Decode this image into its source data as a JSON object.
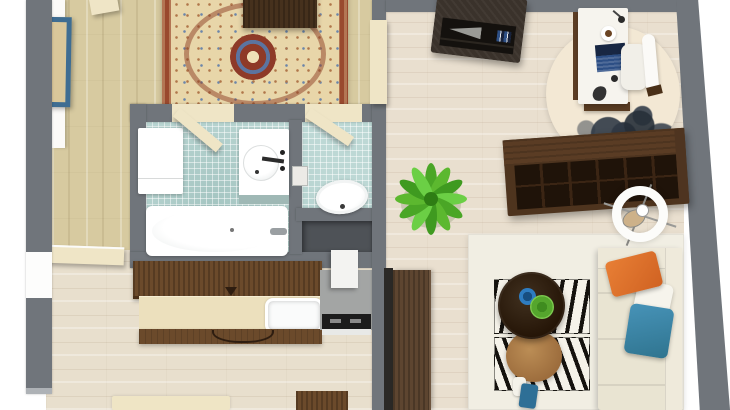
{
  "meta": {
    "title": "3D apartment floor plan — top-down render",
    "description": "Overhead 3D rendering of a small apartment: room with oriental rug, bathroom with separate WC, kitchen, hallway and living room with home office corner."
  },
  "palette": {
    "wall": "#70757b",
    "wallOpening": "#fdfdfc",
    "floorTan": "#d7caa0",
    "floorHall": "#e8dfcd",
    "floorLiving": "#e9dfcf",
    "tile": "#bdd8d5",
    "fixture": "#ffffff",
    "doorCream": "#efe5c6",
    "rugBorder": "#99492e",
    "rugField": "#e8d6a9",
    "rugMedallion": "#8e3a28",
    "artBlue": "#3e6d92",
    "cabinetBrown": "#6b4a2b",
    "counterCream": "#ece0bd",
    "stoveGray": "#a3a5a4",
    "stoveBlack": "#1c1c1c",
    "hoodWhite": "#f3f3f1",
    "nicheGray": "#4e5257",
    "tvDark": "#3a322b",
    "deskWhite": "#f6f4ee",
    "laptopBlue": "#2d4f85",
    "chairWhite": "#f1efe8",
    "shelfBrown": "#5a3c24",
    "shelfDark": "#1f1309",
    "plantGreen": "#54b02e",
    "areaRug": "#f1eee3",
    "zebraBg": "#f5f2e9",
    "zebraInk": "#15120e",
    "tableDark": "#2f2014",
    "tableTan": "#b5854e",
    "bowlBlue": "#2e7cc0",
    "bowlGreen": "#5fb437",
    "sofaCream": "#e9e4d2",
    "pillowOrange": "#e0702b",
    "pillowWhite": "#f6f4ec",
    "pillowBlue": "#3d87ab",
    "vaseBlue": "#2e6f96",
    "sideboard": "#5d4530",
    "matCream": "#efe5c5",
    "ringLamp": "#fcfcfa"
  },
  "rooms": {
    "bedroom": {
      "label": "Room with oriental rug",
      "furniture": [
        "oriental rug",
        "storage box",
        "blue wall art",
        "open doors"
      ]
    },
    "bathroom": {
      "label": "Bathroom with separate WC",
      "furniture": [
        "bathtub",
        "sink vanity",
        "washer cabinet",
        "toilet",
        "storage niche"
      ]
    },
    "kitchen": {
      "label": "Kitchen",
      "furniture": [
        "wall cabinets",
        "counter with sink",
        "stove",
        "range hood"
      ]
    },
    "hallway": {
      "label": "Hallway",
      "furniture": [
        "entry door",
        "door mat"
      ]
    },
    "living": {
      "label": "Living room with office corner",
      "furniture": [
        "media cabinet",
        "desk",
        "desk chair",
        "laptop",
        "bookshelf",
        "ring floor lamp",
        "potted plant",
        "area rug",
        "zebra rugs",
        "round coffee tables",
        "corner sofa",
        "sideboard"
      ]
    }
  }
}
